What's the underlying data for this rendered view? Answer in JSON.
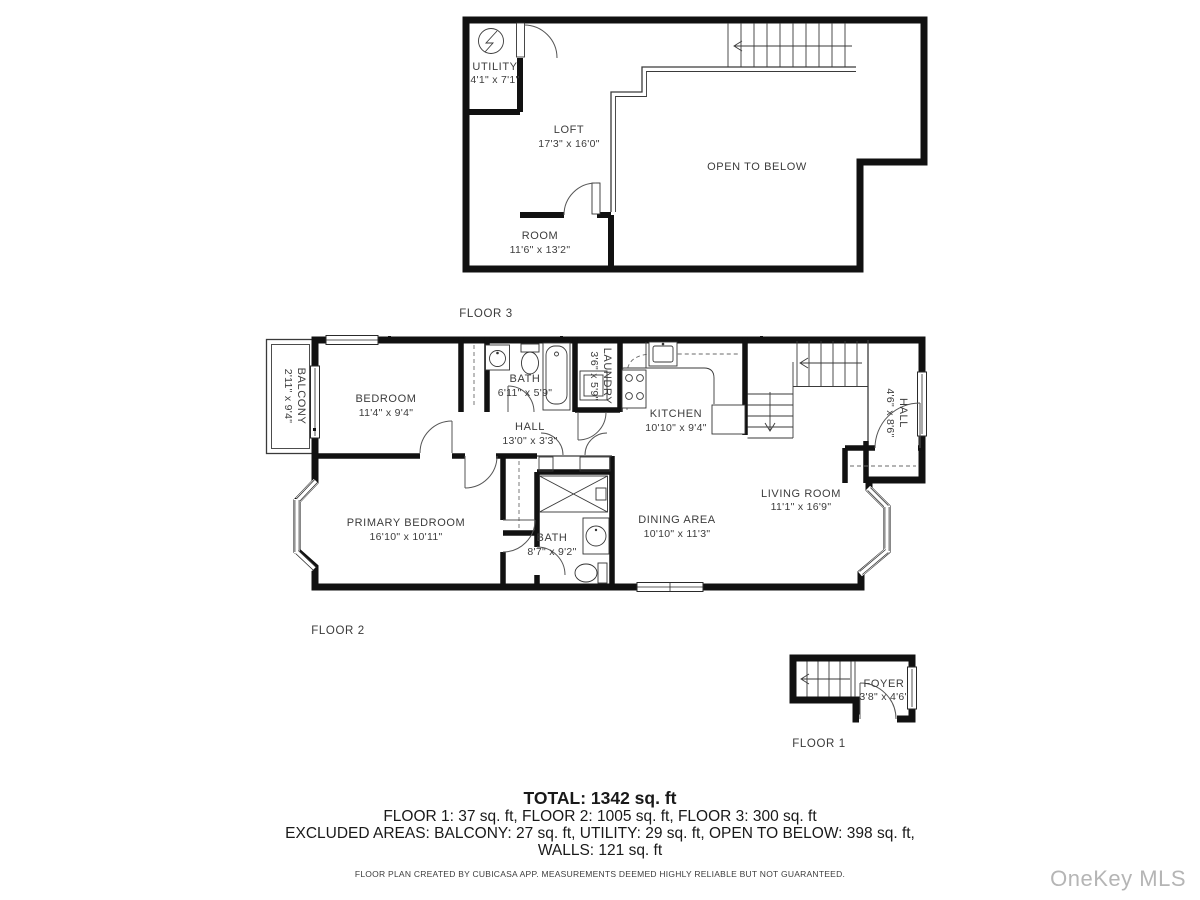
{
  "floors": {
    "floor3": {
      "label": "FLOOR 3",
      "rooms": {
        "utility": {
          "name": "UTILITY",
          "dims": "4'1\" x 7'1\""
        },
        "loft": {
          "name": "LOFT",
          "dims": "17'3\" x 16'0\""
        },
        "open_to_below": {
          "name": "OPEN TO BELOW"
        },
        "room": {
          "name": "ROOM",
          "dims": "11'6\" x 13'2\""
        }
      }
    },
    "floor2": {
      "label": "FLOOR 2",
      "rooms": {
        "balcony": {
          "name": "BALCONY",
          "dims": "2'11\" x 9'4\""
        },
        "bedroom": {
          "name": "BEDROOM",
          "dims": "11'4\" x 9'4\""
        },
        "bath_top": {
          "name": "BATH",
          "dims": "6'11\" x 5'9\""
        },
        "laundry": {
          "name": "LAUNDRY",
          "dims": "3'6\" x 5'9\""
        },
        "kitchen": {
          "name": "KITCHEN",
          "dims": "10'10\" x 9'4\""
        },
        "hall_center": {
          "name": "HALL",
          "dims": "13'0\" x 3'3\""
        },
        "hall_right": {
          "name": "HALL",
          "dims": "4'6\" x 8'6\""
        },
        "living_room": {
          "name": "LIVING ROOM",
          "dims": "11'1\" x 16'9\""
        },
        "dining_area": {
          "name": "DINING AREA",
          "dims": "10'10\" x 11'3\""
        },
        "primary_bedroom": {
          "name": "PRIMARY BEDROOM",
          "dims": "16'10\" x 10'11\""
        },
        "bath_bottom": {
          "name": "BATH",
          "dims": "8'7\" x 9'2\""
        }
      }
    },
    "floor1": {
      "label": "FLOOR 1",
      "rooms": {
        "foyer": {
          "name": "FOYER",
          "dims": "3'8\" x 4'6\""
        }
      }
    }
  },
  "summary": {
    "total": "TOTAL: 1342 sq. ft",
    "floors_line": "FLOOR 1: 37 sq. ft, FLOOR 2: 1005 sq. ft, FLOOR 3: 300 sq. ft",
    "excluded_line": "EXCLUDED AREAS: BALCONY: 27 sq. ft, UTILITY: 29 sq. ft, OPEN TO BELOW: 398 sq. ft,",
    "walls_line": "WALLS: 121 sq. ft"
  },
  "disclaimer": "FLOOR PLAN CREATED BY CUBICASA APP. MEASUREMENTS DEEMED HIGHLY RELIABLE BUT NOT GUARANTEED.",
  "watermark": "OneKey MLS",
  "colors": {
    "wall": "#111111",
    "label": "#3c3c3c",
    "watermark": "#b5b5b5"
  }
}
